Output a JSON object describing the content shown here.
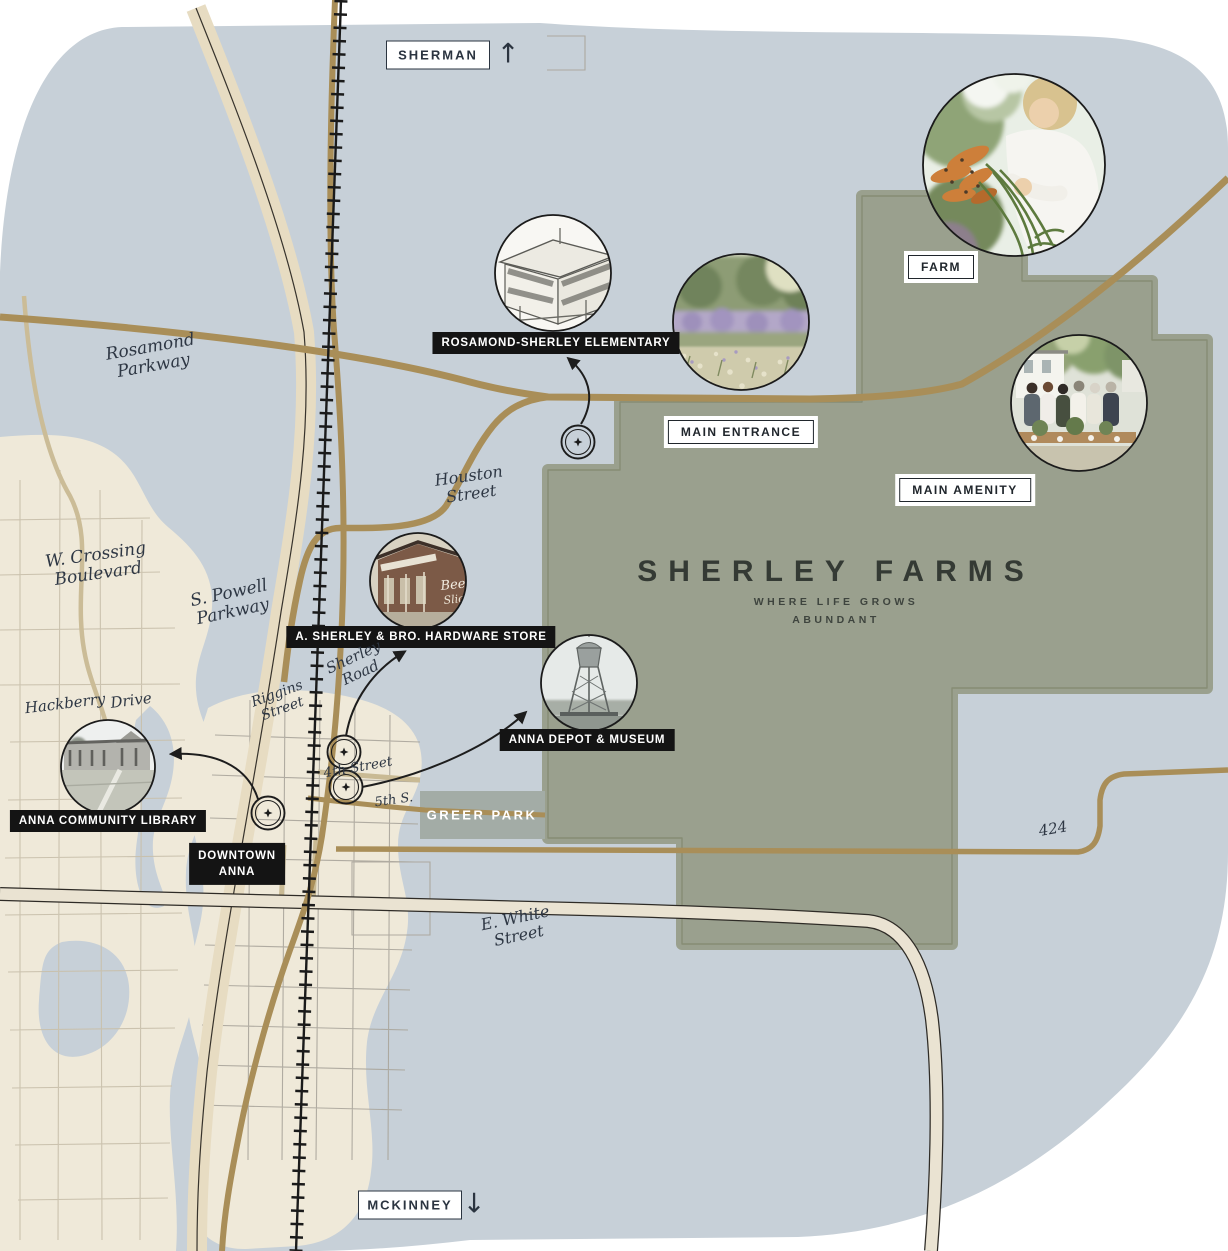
{
  "map_title": {
    "title": "SHERLEY FARMS",
    "tagline_line1": "WHERE LIFE GROWS",
    "tagline_line2": "ABUNDANT"
  },
  "direction_labels": {
    "north_city": "SHERMAN",
    "north_arrow": "↑",
    "south_city": "MCKINNEY",
    "south_arrow": "↓"
  },
  "area_labels": {
    "farm": "FARM",
    "main_entrance": "MAIN ENTRANCE",
    "main_amenity": "MAIN AMENITY",
    "greer_park": "GREER PARK"
  },
  "poi_labels": {
    "elementary": "ROSAMOND-SHERLEY ELEMENTARY",
    "hardware_store": "A. SHERLEY & BRO. HARDWARE STORE",
    "depot_museum": "ANNA DEPOT & MUSEUM",
    "library": "ANNA COMMUNITY LIBRARY",
    "downtown_line1": "DOWNTOWN",
    "downtown_line2": "ANNA"
  },
  "streets": {
    "rosamond": [
      "Rosamond",
      "Parkway"
    ],
    "crossing": [
      "W. Crossing",
      "Boulevard"
    ],
    "powell": [
      "S. Powell",
      "Parkway"
    ],
    "houston": [
      "Houston",
      "Street"
    ],
    "hackberry": [
      "Hackberry",
      "Drive"
    ],
    "riggins": [
      "Riggins",
      "Street"
    ],
    "sherley_road": [
      "Sherley",
      "Road"
    ],
    "fourth": "4th Street",
    "fifth": "5th S.",
    "white": [
      "E. White",
      "Street"
    ],
    "route424": "424"
  },
  "photos": {
    "farm_girl": "girl-holding-fresh-carrots",
    "lavender_field": "lavender-field",
    "main_amenity_gathering": "outdoor-farm-table-gathering",
    "elementary_sketch": "school-building-sketch",
    "hardware_store_photo": "historic-hardware-store",
    "water_tower_photo": "anna-water-tower",
    "library_photo": "anna-community-library-building",
    "hardware_wall_sign_line1": "Beech",
    "hardware_wall_sign_line2": "Sliced"
  },
  "colors": {
    "map_blue": "#c7d0d8",
    "land_beige": "#efe9d9",
    "farm_green": "#9aa08e",
    "farm_outline": "#868c74",
    "road_gold": "#a98e58",
    "road_light": "#cbbc97",
    "highway_beige": "#e7dcc2",
    "highway_line": "#37332c",
    "white_street_beige": "#eae3d2",
    "railroad_black": "#1a1a1a",
    "label_black": "#141414",
    "label_ink": "#2b3440",
    "greer_park_green": "#a3aca6",
    "script_ink": "#2e3744"
  }
}
